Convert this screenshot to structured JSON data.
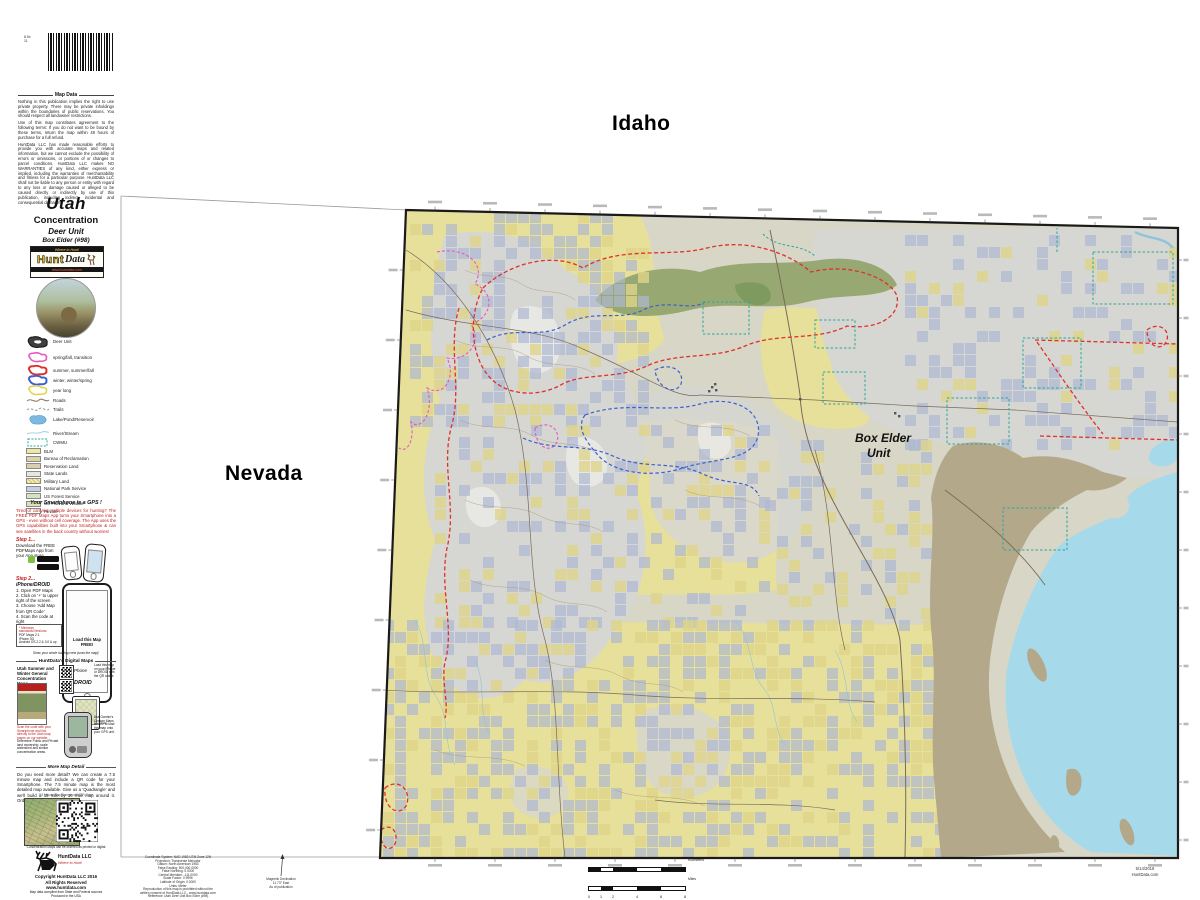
{
  "labels": {
    "idaho": "Idaho",
    "nevada": "Nevada"
  },
  "sidebar": {
    "size_note_1": "8.5x",
    "size_note_2": "11",
    "map_data": {
      "heading": "Map Data",
      "p1": "Nothing in this publication implies the right to use private property.  There may be private inholdings within the boundaries of public reservations.  You should respect all landowner restrictions.",
      "p2": "Use of this map constitutes agreement to the following terms:  If you do not want to be bound by these terms, return the map within 48 hours of purchase for a full refund.",
      "p3": "HuntData LLC has made reasonable efforts to provide you with accurate maps and related information, but we cannot exclude the possibility of errors or omissions, or portions of or changes to parcel conditions.  HuntData LLC makes NO WARRANTIES of any kind, either express or implied, including the warranties of merchantability and fitness for a particular purpose.  HuntData LLC shall not be liable to any person or entity with regard to any loss or damage caused or alleged to be caused directly or indirectly by use of this publication, including indirect, incidental and consequential damages."
    },
    "title": {
      "state": "Utah",
      "type": "Concentration",
      "unit_type": "Deer Unit",
      "unit_name": "Box Elder (#98)"
    },
    "logo": {
      "banner": "Where to Hunt!",
      "brand_hunt": "Hunt",
      "brand_data": "Data",
      "url": "www.huntdata.com"
    },
    "legend": {
      "items": [
        {
          "label": "Deer Unit",
          "color": "#3f3f3f"
        },
        {
          "label": "spring/fall, transition",
          "color": "#e558c0"
        },
        {
          "label": "summer, summer/fall",
          "color": "#e0302a"
        },
        {
          "label": "winter, winter/spring",
          "color": "#3a5fd0"
        },
        {
          "label": "year long",
          "color": "#e3d44c"
        },
        {
          "label": "Roads",
          "color": "#8a7a66"
        },
        {
          "label": "Trails",
          "color": "#9a9a9a"
        },
        {
          "label": "Lake/Pond/Reservoir",
          "color": "#7db8e0"
        },
        {
          "label": "River/Stream",
          "color": "#a9d3e6"
        },
        {
          "label": "CWMU",
          "color": "#2aa79a"
        },
        {
          "label": "BLM",
          "color": "#efe8a2"
        },
        {
          "label": "Bureau of Reclamation",
          "color": "#dcd3a6"
        },
        {
          "label": "Reservation Land",
          "color": "#d8cfae"
        },
        {
          "label": "State Lands",
          "color": "#e7e7df"
        },
        {
          "label": "Military Land",
          "color": "#f1ecbe"
        },
        {
          "label": "National Park Service",
          "color": "#c4cfdf"
        },
        {
          "label": "US Forest Service",
          "color": "#d5e3c0"
        },
        {
          "label": "US Fish and Wildlife",
          "color": "#dee2b2"
        },
        {
          "label": "Private",
          "color": "#ffffff"
        }
      ]
    },
    "gps": {
      "heading": "Your Smartphone is a GPS !",
      "intro": "Tired of carrying multiple devices for hunting?  The FREE PDF Maps App turns your Smartphone into a GPS - even without cell coverage.  The App uses the GPS capabilities built into your Smartphone & can see satellites in the back country without worries!",
      "step1_label": "Step 1...",
      "step1_text": "Download the FREE PDFMaps App from your App store.",
      "step2_label": "Step 2...",
      "device_line": "iPhone/DROID",
      "steps": [
        "1.  Open PDF Maps",
        "2.  Click on '+' to upper right of the screen",
        "3.  Choose 'Add Map from QR Code'",
        "4.  Scan the code at right"
      ],
      "phone_screen": "Load this Map FREE!",
      "min_title": "* Minimum standards/Versions:",
      "min_items": [
        "PDF Maps 2.1",
        "iPhone 3G",
        "Android OS 2.2 & 3.0 & up"
      ],
      "crew_note": "Show your whole hunting crew (scan the map)!"
    },
    "digital": {
      "heading": "HuntData's Digital Maps",
      "left_text": "Utah Summer and Winter General Concentration Maps",
      "grid_note": "Load this map on your iPhone or DROID with the QR codes",
      "phone_label": "Phone",
      "droid_label": "DROID",
      "ipad_label": "iPad",
      "scan_note": "Scan the code with your Smartphone and link directly to the Utah map pages on our website.",
      "garmin_note": "Use Garmin's Custom Maps feature to load this map onto your GPS unit.",
      "ownership_note": "Determine Public and Private land ownership, scale watershed and similar concentration areas."
    },
    "detail": {
      "heading": "More Map Detail",
      "body": "Do you need more detail?  We can create a 7.5 minute map and include a QR code for your Smartphone.  The 7.5 minute map is the most detailed map available.  Give us a 'Quadrangle' and we'll build a 15 mile by 10 mile map around it.  Order one at www.huntdata.com",
      "sample_caption": "7.5 Minute Map Sample with QR Code",
      "caption": "Concentration Maps can be ordered as printed or digital"
    },
    "copyright": {
      "brand": "HuntData LLC",
      "tagline": "Where to Hunt!",
      "line1": "Copyright HuntData LLC 2016",
      "line2": "All Rights Reserved",
      "line3": "www.huntdata.com",
      "fine1": "Map data compiled from State and Federal sources",
      "fine2": "Produced in the USA"
    }
  },
  "map": {
    "unit_label_1": "Box Elder",
    "unit_label_2": "Unit",
    "colors": {
      "base": "#d8d6c6",
      "blm": "#e7e09a",
      "gray": "#d6d6d2",
      "forest": "#97a873",
      "forest_dark": "#7e9a5e",
      "lake": "#a6d9ea",
      "flats": "#b4a88b",
      "checker": "#aeb8d2",
      "checker_yellow": "#ded489",
      "red": "#e0302a",
      "blue": "#3a5fd0",
      "magenta": "#e558c0",
      "teal": "#2aa79a",
      "road": "#7a6a58",
      "contour": "#a8906c",
      "stream": "#8fc4dc",
      "border": "#1a1a1a"
    }
  },
  "footer": {
    "projection_lines": [
      "Coordinate System: NAD 1983 UTM Zone 12N",
      "Projection: Transverse Mercator",
      "Datum: North American 1983",
      "False Easting: 500,000.0000",
      "False Northing: 0.0000",
      "Central Meridian: -111.0000",
      "Scale Factor: 0.9996",
      "Latitude of Origin: 0.0000",
      "Units: Meter",
      "Reproduction of this map is prohibited without the",
      "written consent of HuntData LLC - www.huntdata.com",
      "Reference: Utah Deer Unit Box Elder (#98)"
    ],
    "declination": {
      "title": "Magnetic Declination",
      "value": "11.73° East",
      "note": "As of publication"
    },
    "scale": {
      "miles_numbers": [
        "0",
        "1",
        "2",
        "4",
        "6",
        "8"
      ],
      "miles_label": "Miles",
      "km_label": "Kilometers"
    },
    "stamp": {
      "date": "5/14/2016",
      "site": "HuntData.com"
    }
  }
}
